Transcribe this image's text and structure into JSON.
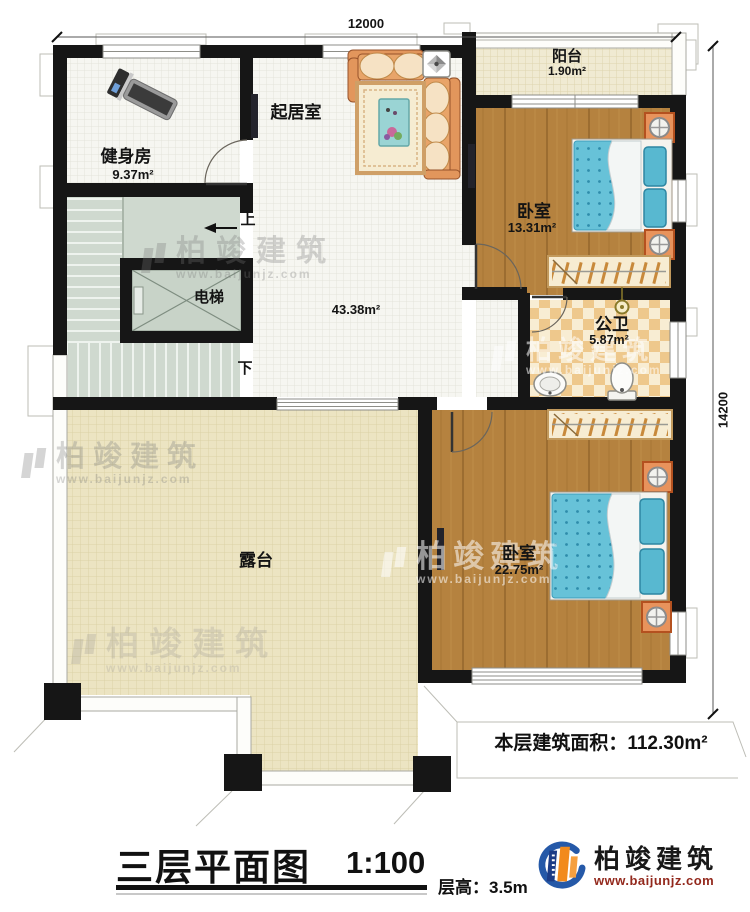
{
  "plan": {
    "title": "三层平面图",
    "scale": "1:100",
    "floor_height": "层高：3.5m",
    "total_area": "本层建筑面积：112.30m²",
    "dim_top": "12000",
    "dim_right": "14200"
  },
  "rooms": {
    "gym": {
      "label": "健身房",
      "area": "9.37m²"
    },
    "living": {
      "label": "起居室",
      "area": "43.38m²"
    },
    "balcony": {
      "label": "阳台",
      "area": "1.90m²"
    },
    "bedroom1": {
      "label": "卧室",
      "area": "13.31m²"
    },
    "bathroom": {
      "label": "公卫",
      "area": "5.87m²"
    },
    "elevator": {
      "label": "电梯"
    },
    "terrace": {
      "label": "露台"
    },
    "bedroom2": {
      "label": "卧室",
      "area": "22.75m²"
    }
  },
  "stairs": {
    "up_label": "上",
    "down_label": "下"
  },
  "logo": {
    "name": "柏竣建筑",
    "website": "www.baijunjz.com",
    "blue": "#2559a8",
    "orange": "#f28a1c"
  },
  "watermark": {
    "text": "柏竣建筑",
    "url": "www.baijunjz.com"
  }
}
